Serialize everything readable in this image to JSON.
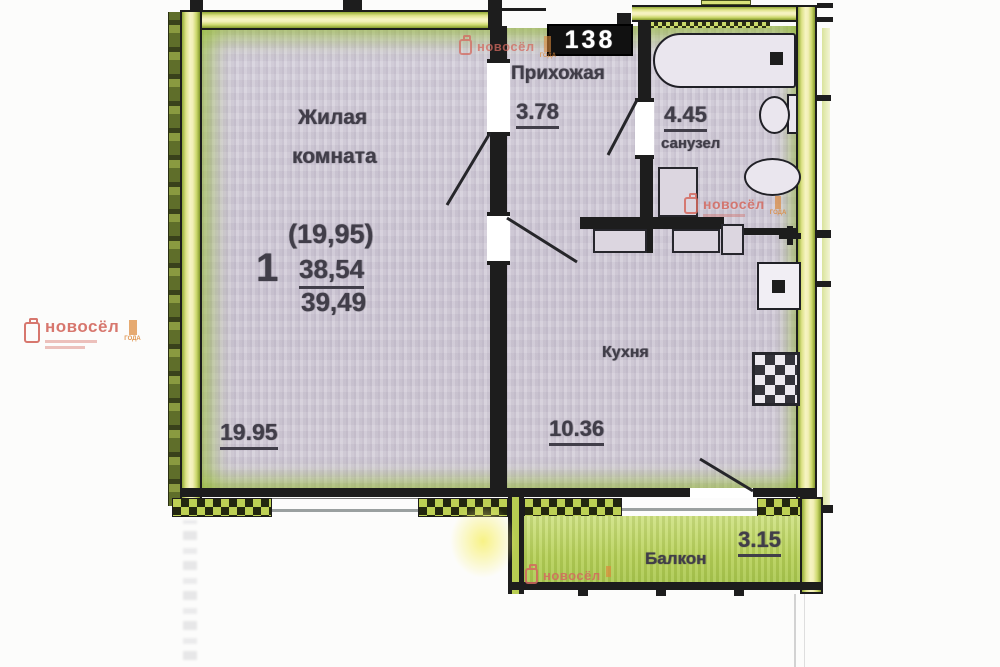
{
  "plan": {
    "apartment_badge": "138",
    "summary": {
      "rooms": "1",
      "living_area": "(19,95)",
      "area_no_balcony": "38,54",
      "area_total": "39,49"
    },
    "living_room": {
      "label_line1": "Жилая",
      "label_line2": "комната",
      "area": "19.95"
    },
    "hallway": {
      "label": "Прихожая",
      "area": "3.78"
    },
    "bathroom": {
      "label": "санузел",
      "area": "4.45"
    },
    "kitchen": {
      "label": "Кухня",
      "area": "10.36"
    },
    "balcony": {
      "label": "Балкон",
      "area": "3.15"
    }
  },
  "watermarks": {
    "brand": "новосёл",
    "award": "ГОДА",
    "brand_color": "#d4695f",
    "accent_color": "#dd8a3c"
  },
  "colors": {
    "wall_highlight": "#d9e27a",
    "room_fill": "#d2ccd8",
    "balcony_fill": "#bcd35f",
    "line": "#1d1d1d"
  }
}
